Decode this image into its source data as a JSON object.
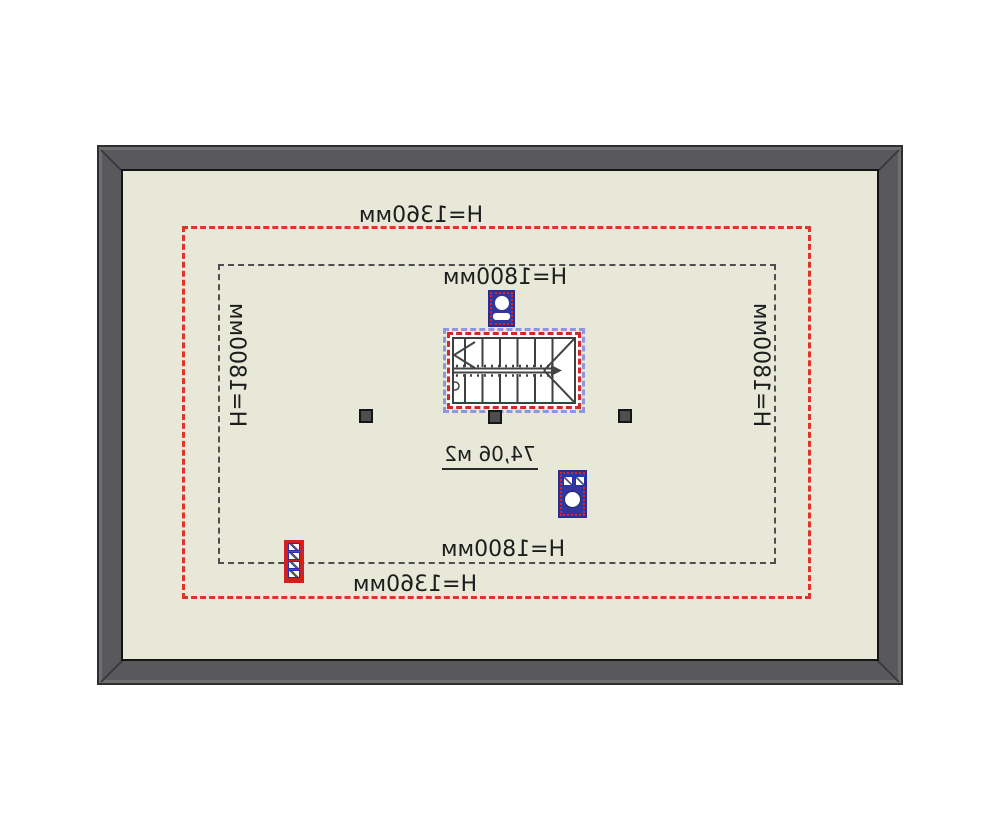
{
  "plan": {
    "type": "attic-floor-plan",
    "mirrored_rendering": "all text appears horizontally flipped",
    "area_label": "74,06 м2",
    "height_labels": {
      "top_outer": "H=1360мм",
      "top_inner": "H=1800мм",
      "left": "H=1800мм",
      "right": "H=1800мм",
      "bottom_inner": "H=1800мм",
      "bottom_outer": "H=1360мм"
    },
    "colors": {
      "floor": "#e7e8d8",
      "wall": "#59595b",
      "zone_1360_outline": "#e0332a",
      "zone_1800_outline": "#4e4e4e",
      "stair_outline_blue": "#9095e2",
      "stair_outline_red": "#d2282a",
      "chimney_blue": "#34349f",
      "chimney_red": "#cc2222",
      "text": "#1d1d1d"
    },
    "symbols": {
      "staircase": "double-flight stair with direction arrow",
      "chimneys": 3,
      "columns": 3
    }
  }
}
